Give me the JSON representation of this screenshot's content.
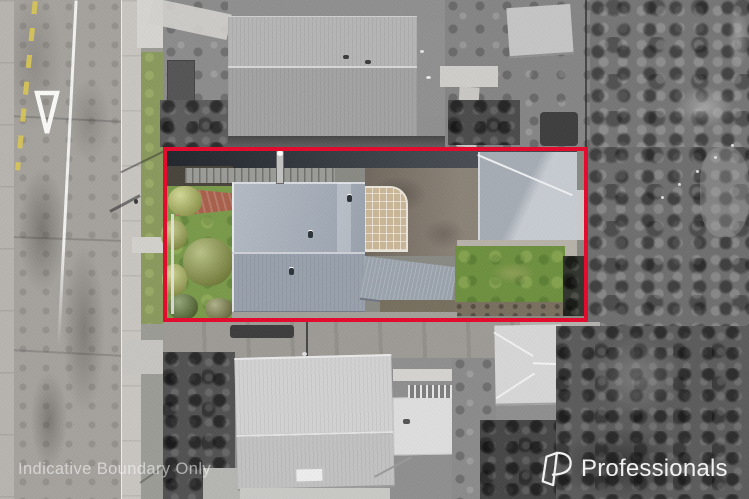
{
  "scene": {
    "type": "aerial-property-photo",
    "watermark": {
      "text": "Indicative Boundary Only",
      "color": "#ffffff"
    },
    "brand": {
      "name": "Professionals",
      "icon": "professionals-p-logo",
      "color": "#ffffff"
    },
    "boundary": {
      "style": "solid",
      "color": "#e30b2d"
    }
  },
  "palette": {
    "lawn_green": "#7a9a4b",
    "bush_yellow_green": "#b9c35f",
    "main_roof_blue_gray": "#a2aab6",
    "garage_roof_gray": "#bfc4ca",
    "driveway_brown": "#7e7569",
    "brick_path_red": "#a8604c",
    "road_gray": "#a5a29d",
    "surroundings_gray": "#8a8a8a"
  }
}
